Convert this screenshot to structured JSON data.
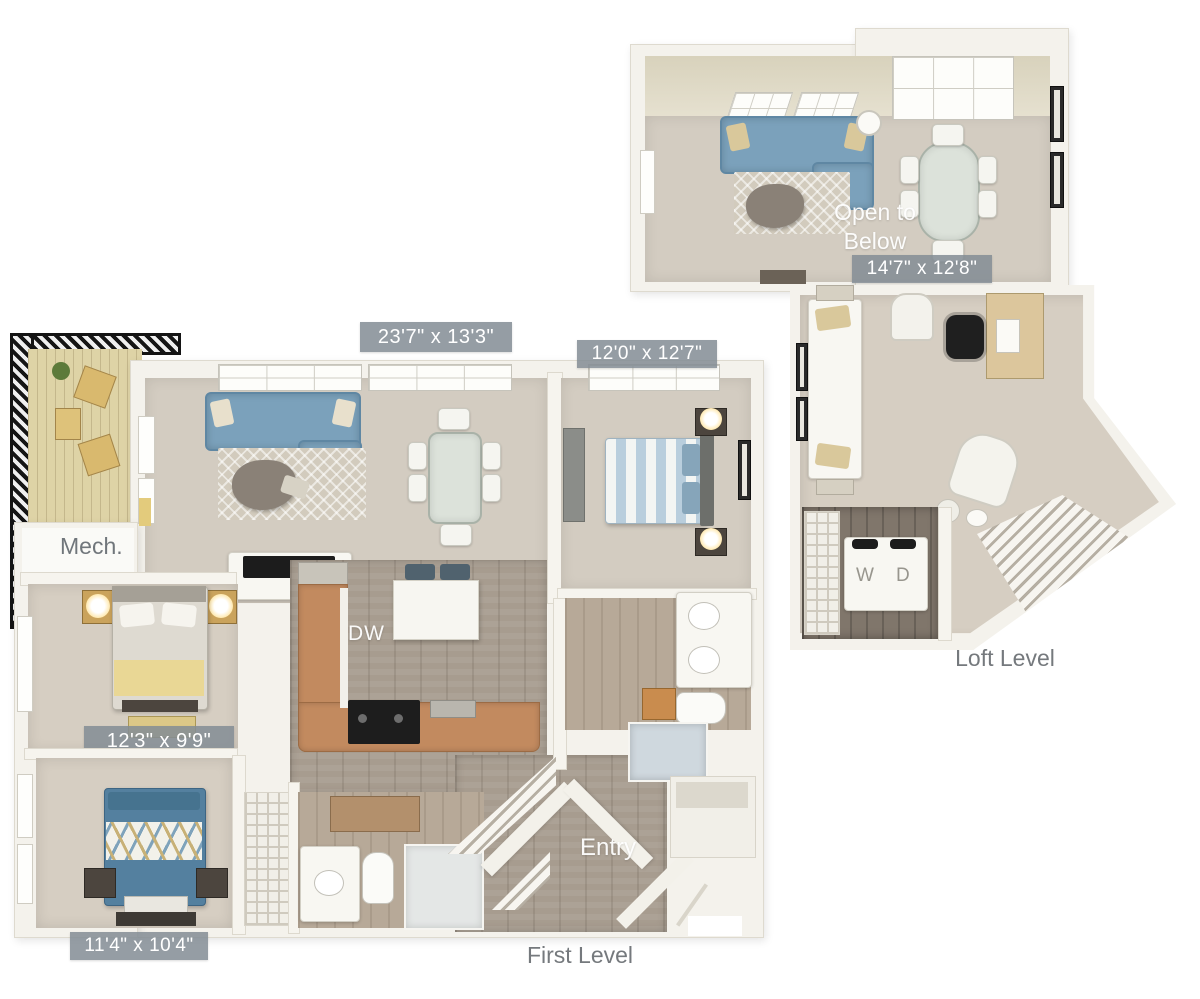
{
  "plan_title": "Two-level apartment floor plan",
  "first_level": {
    "caption": "First Level",
    "dims": {
      "living": "23'7\" x 13'3\"",
      "bedroom_top": "12'0\" x 12'7\"",
      "bedroom_mid": "12'3\" x 9'9\"",
      "bedroom_bottom": "11'4\" x 10'4\""
    },
    "labels": {
      "mech": "Mech.",
      "entry": "Entry",
      "dishwasher": "DW"
    }
  },
  "loft_level": {
    "caption": "Loft Level",
    "open_to_below": "Open to Below",
    "dims": {
      "loft": "14'7\" x 12'8\""
    },
    "laundry": {
      "washer": "W",
      "dryer": "D"
    }
  },
  "colors": {
    "badge_bg": "#828c94",
    "caption_text": "#75797d",
    "sofa_blue": "#7ba1bb",
    "carpet_tan": "#d3ccc1",
    "wood_floor": "#a79c8f",
    "counter_wood": "#c28a5f",
    "railing_black": "#151515",
    "bed_yellow": "#e9d795",
    "bed_blue": "#54809f"
  }
}
